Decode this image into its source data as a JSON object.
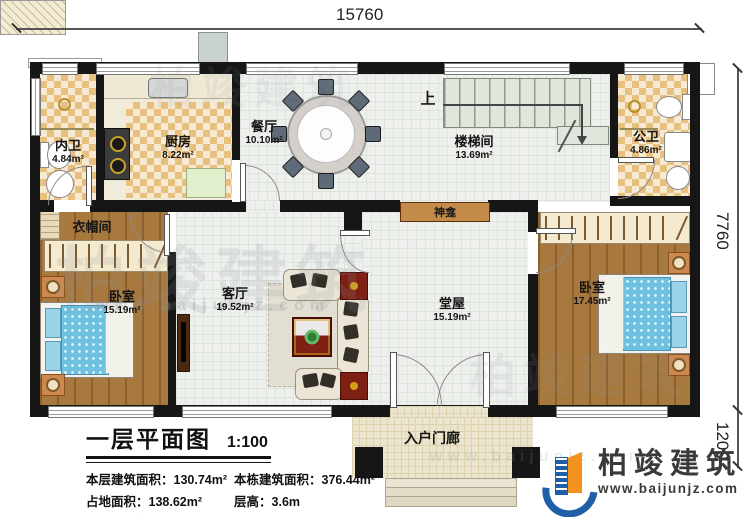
{
  "dimensions": {
    "width_top": "15760",
    "height_right": "7760",
    "porch_depth": "1200"
  },
  "rooms": {
    "inner_bath": {
      "name": "内卫",
      "area": "4.84m²"
    },
    "kitchen": {
      "name": "厨房",
      "area": "8.22m²"
    },
    "dining": {
      "name": "餐厅",
      "area": "10.10m²"
    },
    "stairwell": {
      "name": "楼梯间",
      "area": "13.69m²"
    },
    "public_bath": {
      "name": "公卫",
      "area": "4.86m²"
    },
    "cloakroom": {
      "name": "衣帽间"
    },
    "bedroom_left": {
      "name": "卧室",
      "area": "15.19m²"
    },
    "living_room": {
      "name": "客厅",
      "area": "19.52m²"
    },
    "hall": {
      "name": "堂屋",
      "area": "15.19m²"
    },
    "bedroom_right": {
      "name": "卧室",
      "area": "17.45m²"
    },
    "porch": {
      "name": "入户门廊"
    }
  },
  "annotations": {
    "stairs_up": "上",
    "shrine": "神龛"
  },
  "title_block": {
    "title": "一层平面图",
    "scale": "1:100",
    "stats": [
      {
        "label": "本层建筑面积：",
        "value": "130.74m²"
      },
      {
        "label": "本栋建筑面积：",
        "value": "376.44m²"
      },
      {
        "label": "占地面积：",
        "value": "138.62m²"
      },
      {
        "label": "层高：",
        "value": "3.6m"
      }
    ],
    "note": "注：阳台算半面积，露台不算面积"
  },
  "logo": {
    "company": "柏竣建筑",
    "website": "www.baijunjz.com"
  },
  "watermark": {
    "text": "柏竣建筑",
    "subtext": "www.baijunjz.com"
  },
  "colors": {
    "wall": "#161616",
    "checker": "#e7c080",
    "wood": "#a8793f",
    "tile": "#eef0ed",
    "logo_blue": "#1e5fa8",
    "logo_orange": "#f29320"
  }
}
